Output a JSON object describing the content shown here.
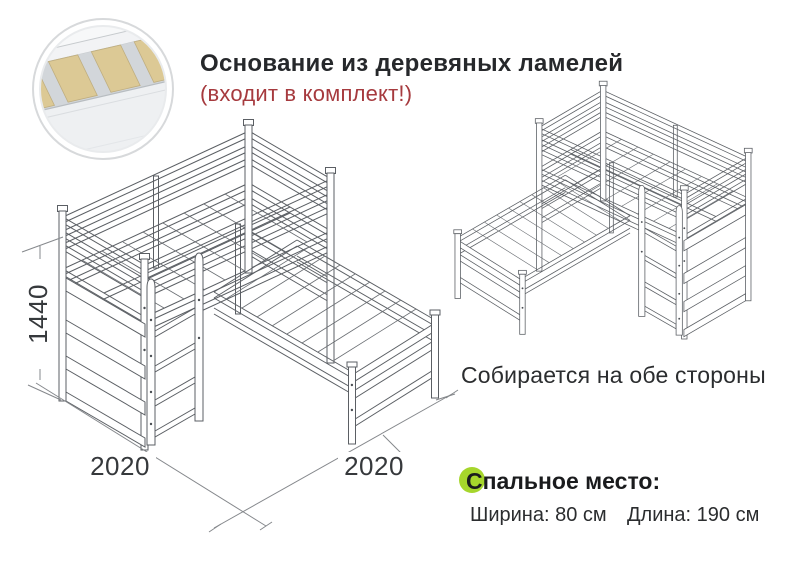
{
  "header": {
    "title": "Основание из деревяных ламелей",
    "subtitle": "(входит в комплект!)"
  },
  "captions": {
    "both_sides": "Собирается на обе стороны"
  },
  "dimensions": {
    "height_mm": "1440",
    "length_left_mm": "2020",
    "length_right_mm": "2020"
  },
  "sleeping_place": {
    "title": "Спальное место:",
    "width": "Ширина: 80 см",
    "length": "Длина: 190 см"
  },
  "icons": {
    "inset": "wooden-slats-photo-inset",
    "bullet": "green-dot-icon"
  },
  "colors": {
    "accent_red": "#a63a3e",
    "bullet_green": "#a6d62c",
    "drawing_line_gray": "#5b5f64",
    "dimension_line_gray": "#85888c",
    "slat_tan": "#dcc995"
  }
}
